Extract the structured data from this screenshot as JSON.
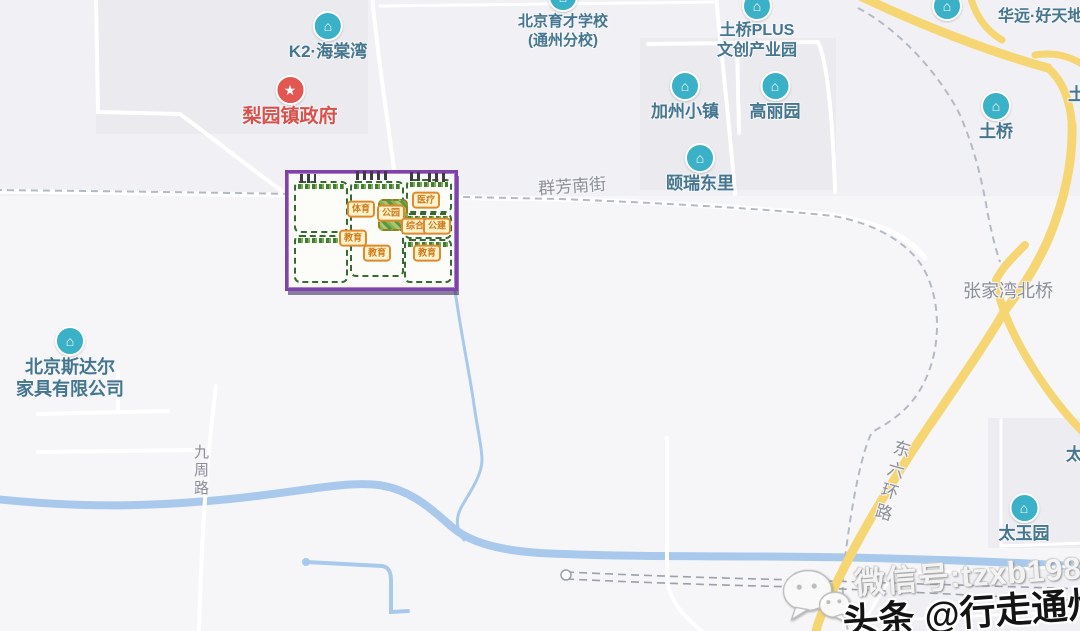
{
  "map": {
    "pois": [
      {
        "label": "K2·海棠湾"
      },
      {
        "label": "梨园镇政府"
      },
      {
        "label": "北京育才学校",
        "label2": "(通州分校)"
      },
      {
        "label": "土桥PLUS",
        "label2": "文创产业园"
      },
      {
        "label": "加州小镇"
      },
      {
        "label": "高丽园"
      },
      {
        "label": "华远·好天地"
      },
      {
        "label": "颐瑞东里"
      },
      {
        "label": "土桥"
      },
      {
        "label": "北京斯达尔",
        "label2": "家具有限公司"
      },
      {
        "label": "太玉园"
      }
    ],
    "road_labels": [
      "群芳南街",
      "张家湾北桥",
      "九周路",
      "东六环路"
    ],
    "partial_labels": [
      "土",
      "太"
    ],
    "overlay": {
      "parcels": [
        "体育",
        "公园",
        "医疗",
        "综合",
        "公建",
        "教育",
        "教育",
        "教育"
      ]
    },
    "watermark": {
      "wechat_line": "微信号:tzxb1986",
      "toutiao_line": "头条 @行走通州"
    }
  }
}
